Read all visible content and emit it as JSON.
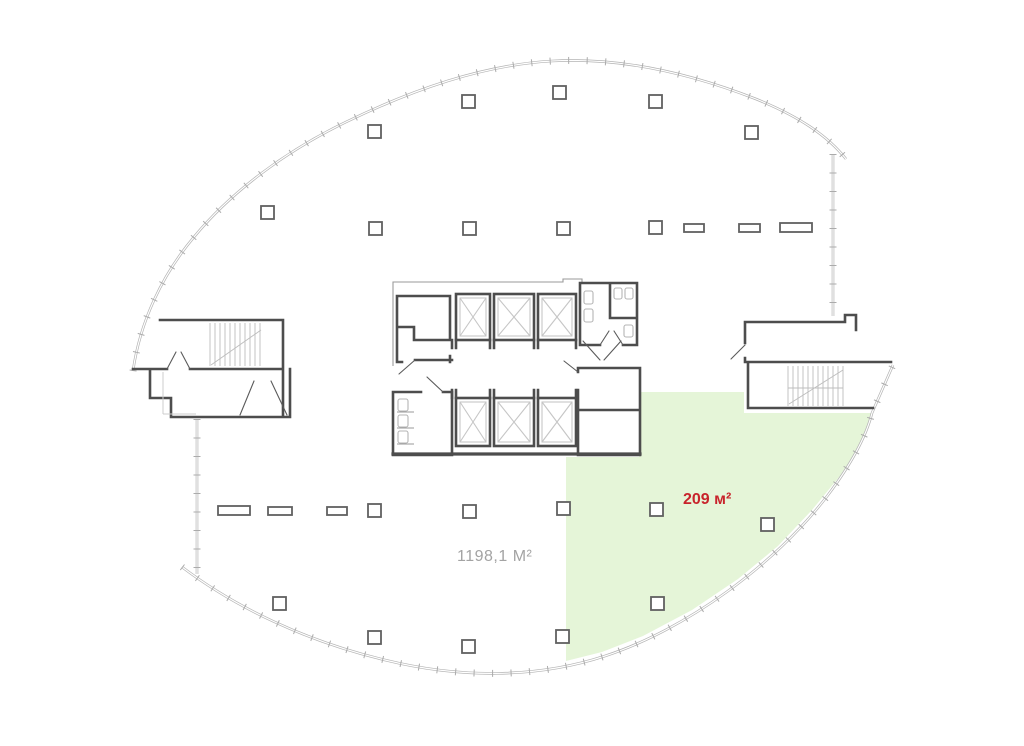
{
  "page": {
    "title": "Office floor plan",
    "background": "#ffffff"
  },
  "labels": {
    "highlighted_unit_area": "209 м²",
    "total_floor_area": "1198,1 М²"
  },
  "colors": {
    "highlight_fill": "#e5f5d8",
    "highlight_text": "#c8232b",
    "total_text": "#a3a3a3",
    "wall": "#4d4d4d",
    "facade": "#b3b3b3",
    "detail": "#c6c6c6"
  },
  "plan": {
    "units": [
      {
        "name": "highlighted-unit",
        "area_label": "209 м²",
        "location": "south-east sector",
        "highlighted": true
      },
      {
        "name": "open-floor",
        "area_label": "1198,1 М²",
        "highlighted": false
      }
    ],
    "features": [
      "elevator-bank-6",
      "stairwell-west",
      "stairwell-east",
      "wc-north",
      "wc-south"
    ],
    "columns": {
      "size": 13,
      "squares": [
        [
          462,
          95
        ],
        [
          553,
          86
        ],
        [
          649,
          95
        ],
        [
          368,
          125
        ],
        [
          745,
          126
        ],
        [
          261,
          206
        ],
        [
          369,
          222
        ],
        [
          463,
          222
        ],
        [
          557,
          222
        ],
        [
          649,
          221
        ],
        [
          368,
          504
        ],
        [
          463,
          505
        ],
        [
          557,
          502
        ],
        [
          650,
          503
        ],
        [
          761,
          518
        ],
        [
          273,
          597
        ],
        [
          368,
          631
        ],
        [
          462,
          640
        ],
        [
          556,
          630
        ],
        [
          651,
          597
        ]
      ],
      "bars": [
        [
          218,
          506,
          32,
          9
        ],
        [
          268,
          507,
          24,
          8
        ],
        [
          327,
          507,
          20,
          8
        ],
        [
          684,
          224,
          20,
          8
        ],
        [
          739,
          224,
          21,
          8
        ],
        [
          780,
          223,
          32,
          9
        ]
      ]
    }
  }
}
